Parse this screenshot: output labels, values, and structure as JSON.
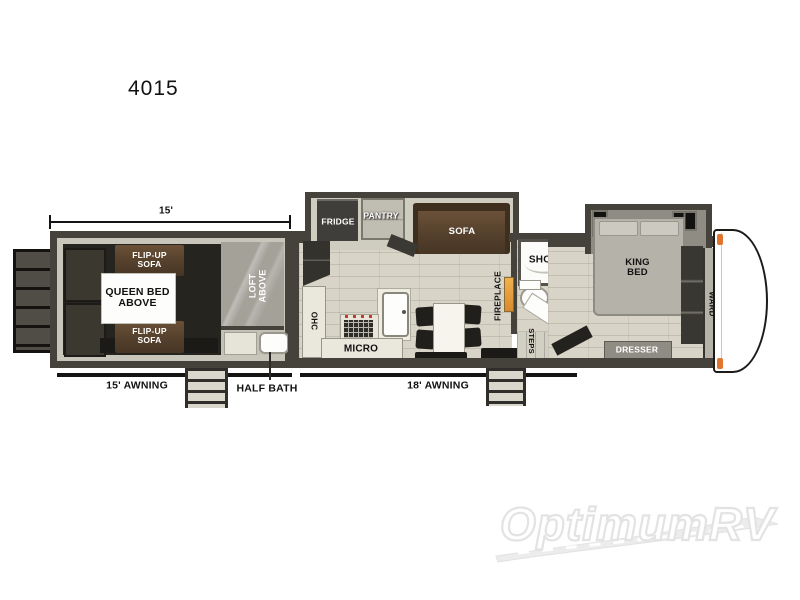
{
  "title": "4015",
  "dimension_label": "15'",
  "awning_left": "15' AWNING",
  "awning_right": "18' AWNING",
  "half_bath_label": "HALF BATH",
  "garage": {
    "flip_up_sofa_top": [
      "FLIP-UP",
      "SOFA"
    ],
    "flip_up_sofa_bottom": [
      "FLIP-UP",
      "SOFA"
    ],
    "queen_bed": [
      "QUEEN BED",
      "ABOVE"
    ],
    "loft": [
      "LOFT",
      "ABOVE"
    ]
  },
  "kitchen": {
    "fridge": "FRIDGE",
    "pantry": "PANTRY",
    "sofa": "SOFA",
    "ohc": "OHC",
    "micro": "MICRO",
    "fireplace": "FIREPLACE"
  },
  "bath": {
    "shower": "SHOWER",
    "steps": "STEPS"
  },
  "bedroom": {
    "king_bed": [
      "KING",
      "BED"
    ],
    "ward": "WARD",
    "dresser": "DRESSER"
  },
  "watermark_brand": "OptimumRV",
  "colors": {
    "wall": "#45423b",
    "floor": "#d8d4c8",
    "sofa_brown": "#5a442e",
    "fireplace_orange": "#e89b3d",
    "cap_accent_orange": "#e0762d"
  }
}
